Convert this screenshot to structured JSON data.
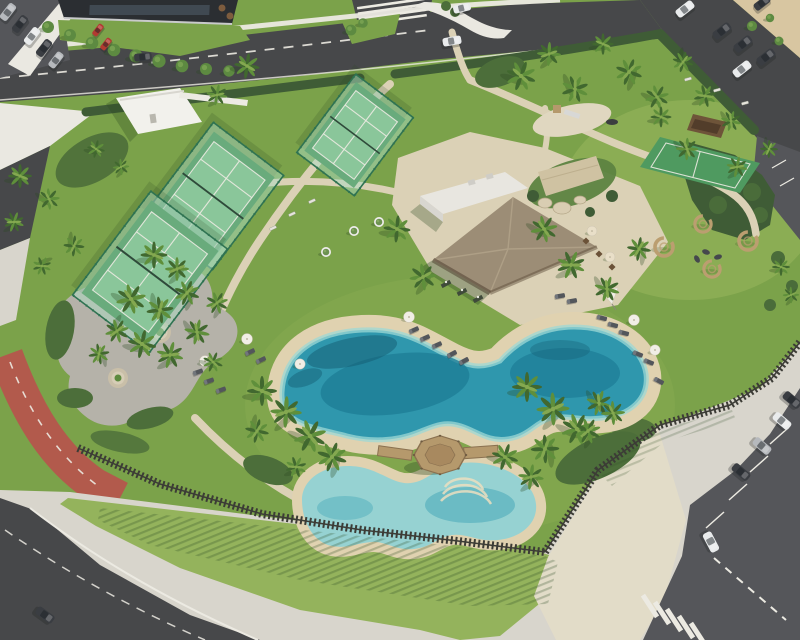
{
  "image": {
    "kind": "aerial-architectural-rendering",
    "subject": "Resort amenity park: lagoon pool with beach edges, kids pool with wooden gazebo deck, thatched-roof clubhouse, three padel courts, multisport court, playground, palm gardens, slat fence, surrounding roads, red bike lane and parking lots"
  },
  "colors": {
    "grass_base": "#7ba24a",
    "grass_light": "#94b35c",
    "grass_tint": "#a3bd66",
    "hedge": "#3f5c36",
    "shrub": "#4c6e3a",
    "palm_dark": "#41682f",
    "palm_mid": "#5f8f3b",
    "palm_light": "#84a850",
    "trunk": "#8d7b5c",
    "tree": "#5d8a41",
    "tree_light": "#76a050",
    "road": "#47484a",
    "road_light": "#55565a",
    "sidewalk": "#d8d5cc",
    "sidewalk_bright": "#eae8e1",
    "path": "#dbd1b6",
    "paver": "#e2dcc8",
    "gravel": "#b5b2a9",
    "sand": "#e0d2b0",
    "beach_sand": "#d8c6a1",
    "pool_deep": "#1d7c96",
    "pool_mid": "#2f97ad",
    "pool_pale": "#9ed8d6",
    "pool_shadow": "#135c72",
    "kids_pool": "#96d2d2",
    "kids_pool_deep": "#58b1bd",
    "court_glass": "#abdcc3",
    "court_frame": "#2f7352",
    "court_turf": "#69ab7c",
    "court_turf_light": "#8ac69a",
    "sport_court": "#4f9a60",
    "line_white": "#eceae2",
    "thatch": "#9c8d76",
    "thatch_light": "#b3a48a",
    "roof_white": "#e8e6e0",
    "wall_white": "#f2f1ec",
    "stone": "#cfc2a2",
    "wood": "#b5996c",
    "wood_dark": "#8a7150",
    "wicker": "#bb9e70",
    "fence": "#3c3c36",
    "red_lane": "#b25a4c",
    "car_white": "#e9ebec",
    "car_dark": "#3a3d42",
    "car_silver": "#b6b9bd",
    "car_red": "#b23a31",
    "lounger": "#53565b",
    "umbrella": "#f1eee6",
    "umbrella_cream": "#e9dfc8",
    "shadow": "#2c4a22"
  },
  "scene": {
    "palms": [
      [
        247,
        66,
        0.85,
        8
      ],
      [
        217,
        95,
        0.7,
        -35
      ],
      [
        20,
        176,
        0.8,
        0
      ],
      [
        49,
        199,
        0.72,
        40
      ],
      [
        14,
        222,
        0.68,
        -25
      ],
      [
        74,
        246,
        0.7,
        95
      ],
      [
        42,
        266,
        0.62,
        160
      ],
      [
        96,
        149,
        0.6,
        12
      ],
      [
        121,
        167,
        0.55,
        -50
      ],
      [
        521,
        76,
        1.0,
        20
      ],
      [
        549,
        54,
        0.8,
        -42
      ],
      [
        575,
        89,
        0.9,
        70
      ],
      [
        603,
        44,
        0.72,
        0
      ],
      [
        629,
        72,
        0.9,
        -70
      ],
      [
        657,
        97,
        0.8,
        30
      ],
      [
        683,
        62,
        0.7,
        105
      ],
      [
        705,
        96,
        0.75,
        -15
      ],
      [
        731,
        121,
        0.68,
        60
      ],
      [
        154,
        255,
        0.9,
        0
      ],
      [
        177,
        269,
        0.8,
        -45
      ],
      [
        131,
        299,
        1.0,
        32
      ],
      [
        160,
        310,
        0.9,
        82
      ],
      [
        187,
        293,
        0.85,
        -70
      ],
      [
        142,
        344,
        0.95,
        12
      ],
      [
        170,
        355,
        0.9,
        -30
      ],
      [
        197,
        332,
        0.85,
        57
      ],
      [
        217,
        303,
        0.75,
        -62
      ],
      [
        117,
        331,
        0.8,
        120
      ],
      [
        99,
        354,
        0.7,
        -100
      ],
      [
        213,
        362,
        0.68,
        22
      ],
      [
        397,
        229,
        0.9,
        5
      ],
      [
        423,
        277,
        0.9,
        -52
      ],
      [
        544,
        229,
        0.9,
        33
      ],
      [
        571,
        265,
        0.95,
        -22
      ],
      [
        607,
        289,
        0.85,
        62
      ],
      [
        639,
        249,
        0.8,
        -82
      ],
      [
        661,
        117,
        0.7,
        0
      ],
      [
        687,
        149,
        0.75,
        47
      ],
      [
        737,
        167,
        0.7,
        -33
      ],
      [
        769,
        149,
        0.6,
        92
      ],
      [
        262,
        391,
        1.0,
        0
      ],
      [
        286,
        412,
        1.05,
        -42
      ],
      [
        310,
        436,
        1.1,
        28
      ],
      [
        332,
        457,
        1.0,
        -72
      ],
      [
        257,
        431,
        0.8,
        102
      ],
      [
        527,
        387,
        1.0,
        0
      ],
      [
        553,
        409,
        1.1,
        -47
      ],
      [
        577,
        429,
        1.05,
        27
      ],
      [
        545,
        449,
        0.95,
        -92
      ],
      [
        599,
        403,
        0.85,
        62
      ],
      [
        505,
        457,
        0.9,
        17
      ],
      [
        531,
        477,
        0.85,
        -37
      ],
      [
        296,
        467,
        0.7,
        -18
      ],
      [
        588,
        431,
        0.85,
        -62
      ],
      [
        613,
        413,
        0.8,
        42
      ],
      [
        781,
        267,
        0.6,
        0
      ],
      [
        791,
        295,
        0.55,
        -47
      ]
    ],
    "trees": [
      [
        48,
        27,
        1
      ],
      [
        70,
        35,
        1
      ],
      [
        92,
        43,
        1.05
      ],
      [
        114,
        50,
        1.05
      ],
      [
        136,
        56,
        1.1
      ],
      [
        159,
        61,
        1.1
      ],
      [
        182,
        66,
        1.05
      ],
      [
        206,
        69,
        1
      ],
      [
        229,
        71,
        0.95
      ],
      [
        351,
        30,
        0.9
      ],
      [
        363,
        23,
        0.8
      ],
      [
        752,
        26,
        0.85
      ],
      [
        779,
        41,
        0.75
      ],
      [
        770,
        18,
        0.7
      ]
    ],
    "cars": [
      [
        8,
        12,
        -52,
        "car_silver",
        0.85
      ],
      [
        20,
        24,
        -52,
        "car_dark",
        0.85
      ],
      [
        32,
        36,
        -52,
        "car_white",
        0.85
      ],
      [
        44,
        48,
        -52,
        "car_dark",
        0.85
      ],
      [
        56,
        60,
        -52,
        "car_silver",
        0.8
      ],
      [
        98,
        30,
        -52,
        "car_red",
        0.6
      ],
      [
        106,
        44,
        -52,
        "car_red",
        0.6
      ],
      [
        143,
        57,
        -6,
        "car_dark",
        0.8
      ],
      [
        452,
        41,
        -10,
        "car_white",
        0.85
      ],
      [
        462,
        8,
        -14,
        "car_white",
        0.8
      ],
      [
        685,
        9,
        -38,
        "car_white",
        0.9
      ],
      [
        722,
        31,
        -38,
        "car_dark",
        0.9
      ],
      [
        743,
        44,
        -38,
        "car_dark",
        0.9
      ],
      [
        766,
        57,
        -38,
        "car_dark",
        0.9
      ],
      [
        742,
        69,
        -38,
        "car_white",
        0.9
      ],
      [
        762,
        3,
        -38,
        "car_dark",
        0.8
      ],
      [
        792,
        400,
        40,
        "car_dark",
        0.9
      ],
      [
        782,
        421,
        40,
        "car_white",
        0.9
      ],
      [
        762,
        446,
        40,
        "car_silver",
        0.9
      ],
      [
        741,
        472,
        40,
        "car_dark",
        0.9
      ],
      [
        711,
        542,
        62,
        "car_white",
        0.95
      ],
      [
        45,
        615,
        36,
        "car_dark",
        0.9
      ]
    ],
    "loungers": [
      [
        198,
        372,
        -20
      ],
      [
        209,
        381,
        -20
      ],
      [
        221,
        390,
        -20
      ],
      [
        250,
        352,
        -25
      ],
      [
        261,
        360,
        -25
      ],
      [
        414,
        330,
        -24
      ],
      [
        425,
        338,
        -24
      ],
      [
        437,
        345,
        -24
      ],
      [
        452,
        354,
        -28
      ],
      [
        464,
        361,
        -28
      ],
      [
        560,
        296,
        -10
      ],
      [
        572,
        301,
        -10
      ],
      [
        602,
        318,
        15
      ],
      [
        613,
        325,
        15
      ],
      [
        624,
        333,
        15
      ],
      [
        638,
        354,
        22
      ],
      [
        649,
        362,
        22
      ],
      [
        659,
        381,
        28
      ]
    ],
    "umbrellas": [
      [
        205,
        361,
        1
      ],
      [
        247,
        339,
        1
      ],
      [
        300,
        364,
        0.95
      ],
      [
        409,
        317,
        1
      ],
      [
        634,
        320,
        1
      ],
      [
        655,
        350,
        0.95
      ],
      [
        592,
        231,
        0.9,
        "umbrella_cream"
      ],
      [
        610,
        257,
        0.9,
        "umbrella_cream"
      ]
    ],
    "pods": [
      [
        664,
        247,
        1
      ],
      [
        703,
        224,
        0.9
      ],
      [
        748,
        241,
        1
      ],
      [
        712,
        269,
        0.9
      ]
    ],
    "planters": [
      [
        326,
        252
      ],
      [
        354,
        231
      ],
      [
        379,
        222
      ]
    ],
    "benches": [
      [
        292,
        214,
        -25
      ],
      [
        312,
        201,
        -25
      ],
      [
        273,
        228,
        -25
      ],
      [
        688,
        79,
        -15
      ],
      [
        717,
        90,
        -15
      ],
      [
        745,
        103,
        -15
      ]
    ]
  }
}
